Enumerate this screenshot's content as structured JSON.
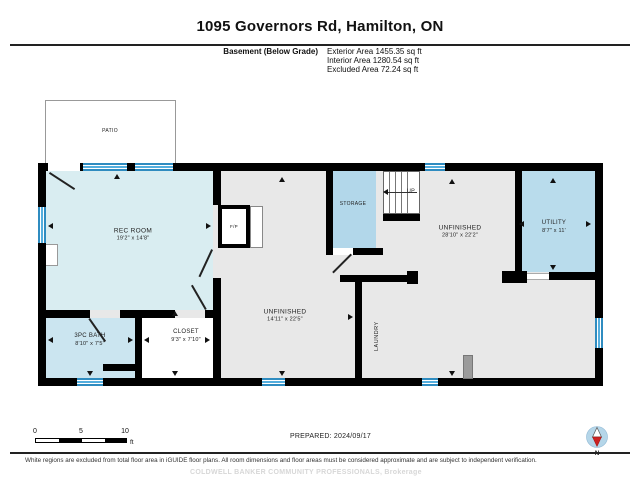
{
  "header": {
    "title": "1095 Governors Rd, Hamilton, ON",
    "floor_label": "Basement (Below Grade)",
    "exterior_area": "Exterior Area 1455.35 sq ft",
    "interior_area": "Interior Area 1280.54 sq ft",
    "excluded_area": "Excluded Area 72.24 sq ft"
  },
  "rooms": {
    "patio": {
      "name": "PATIO"
    },
    "rec_room": {
      "name": "REC ROOM",
      "dims": "19'2\" x 14'8\""
    },
    "bath": {
      "name": "3PC BATH",
      "dims": "8'10\" x 7'5\""
    },
    "closet": {
      "name": "CLOSET",
      "dims": "9'3\" x 7'10\""
    },
    "storage": {
      "name": "STORAGE"
    },
    "laundry": {
      "name": "LAUNDRY"
    },
    "unfinished_mid": {
      "name": "UNFINISHED",
      "dims": "14'11\" x 22'5\""
    },
    "unfinished_right": {
      "name": "UNFINISHED",
      "dims": "28'10\" x 22'2\""
    },
    "utility": {
      "name": "UTILITY",
      "dims": "8'7\" x 11'"
    },
    "fireplace": {
      "name": "F/P"
    },
    "stairs_up": {
      "name": "UP"
    }
  },
  "scale_bar": {
    "tick_0": "0",
    "tick_5": "5",
    "tick_10": "10",
    "unit": "ft"
  },
  "footer": {
    "prepared": "PREPARED: 2024/09/17",
    "compass_north": "N",
    "disclaimer": "White regions are excluded from total floor area in iGUIDE floor plans. All room dimensions and floor areas must be considered approximate and are subject to independent verification.",
    "watermark": "COLDWELL BANKER COMMUNITY PROFESSIONALS, Brokerage"
  },
  "colors": {
    "wall": "#000000",
    "finished_fill": "#d9edf1",
    "bath_fill": "#cbe5f0",
    "storage_fill": "#b2d7ea",
    "utility_fill": "#b9dcec",
    "unfinished_fill": "#e8e8e8",
    "excluded_fill": "#ffffff",
    "window_blue": "#3f9fd4",
    "compass_red": "#cc2222"
  }
}
